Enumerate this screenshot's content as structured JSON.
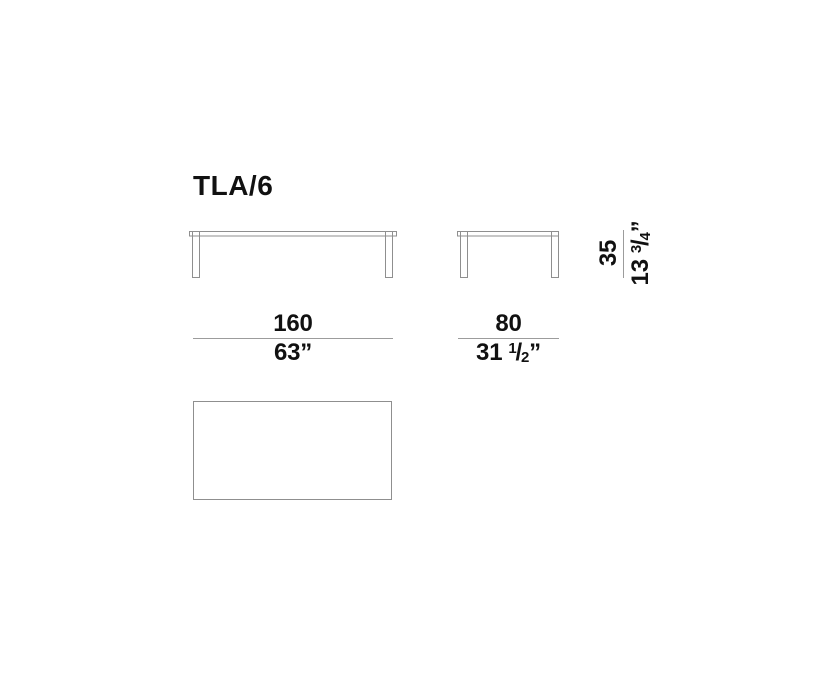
{
  "page": {
    "title": "TLA/6",
    "background": "#ffffff"
  },
  "drawing": {
    "stroke_color": "#8f8f8f",
    "dim_line_color": "#9c9c9c",
    "text_color": "#111111",
    "dimensions": {
      "width": {
        "primary": "160",
        "secondary": "63”"
      },
      "depth": {
        "primary": "80",
        "secondary_whole": "31",
        "frac_numerator": "1",
        "frac_slash": "/",
        "frac_denominator": "2",
        "secondary_suffix": "”"
      },
      "height": {
        "primary": "35",
        "secondary_whole": "13",
        "frac_numerator": "3",
        "frac_slash": "/",
        "frac_denominator": "4",
        "secondary_suffix": "”"
      }
    }
  }
}
